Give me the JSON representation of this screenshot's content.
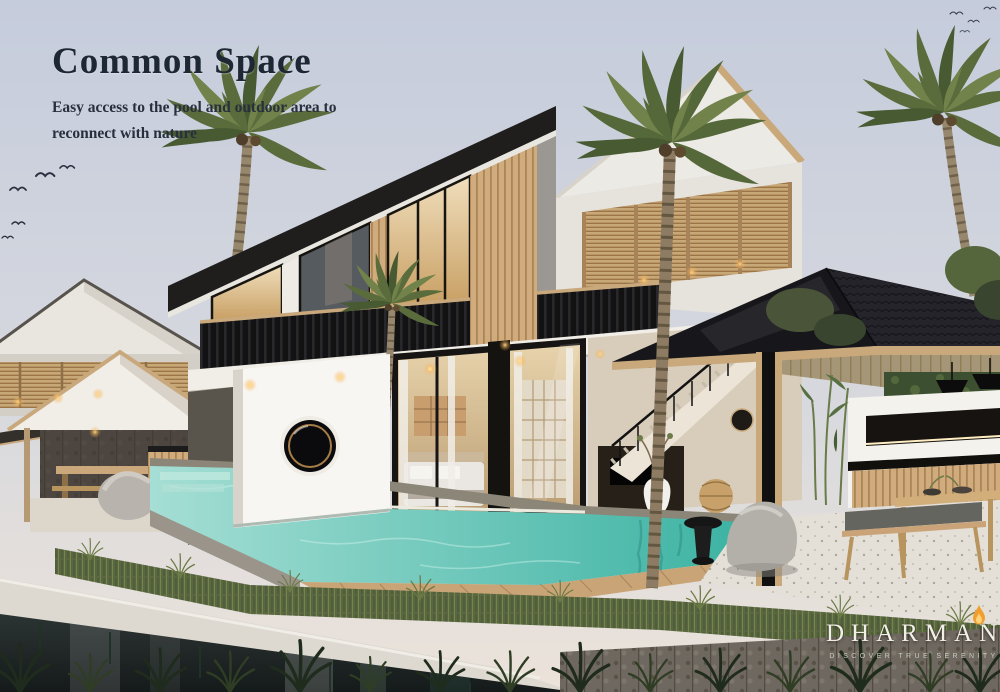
{
  "page": {
    "title": "Common Space",
    "subtitle_line1": "Easy access to the pool and outdoor area to",
    "subtitle_line2": "reconnect with nature"
  },
  "brand": {
    "name": "DHARMAN",
    "tagline": "DISCOVER TRUE SERENITY"
  },
  "icons": {
    "flame": "flame-icon",
    "birds": "bird-icon",
    "porthole": "porthole-window-icon"
  },
  "colors": {
    "sky_top": "#c5ccdc",
    "sky_mid": "#d6d8de",
    "sky_horizon": "#ece3da",
    "roof_dark": "#201e1c",
    "wood_slat": "#cfa97c",
    "pool_light": "#a5ded4",
    "pool_deep": "#3db3a3",
    "grass": "#5c6742",
    "flame_orange": "#f09e2e",
    "flame_core": "#ffd27a",
    "title_text": "#1e2734",
    "logo_text": "#f2efe6"
  }
}
